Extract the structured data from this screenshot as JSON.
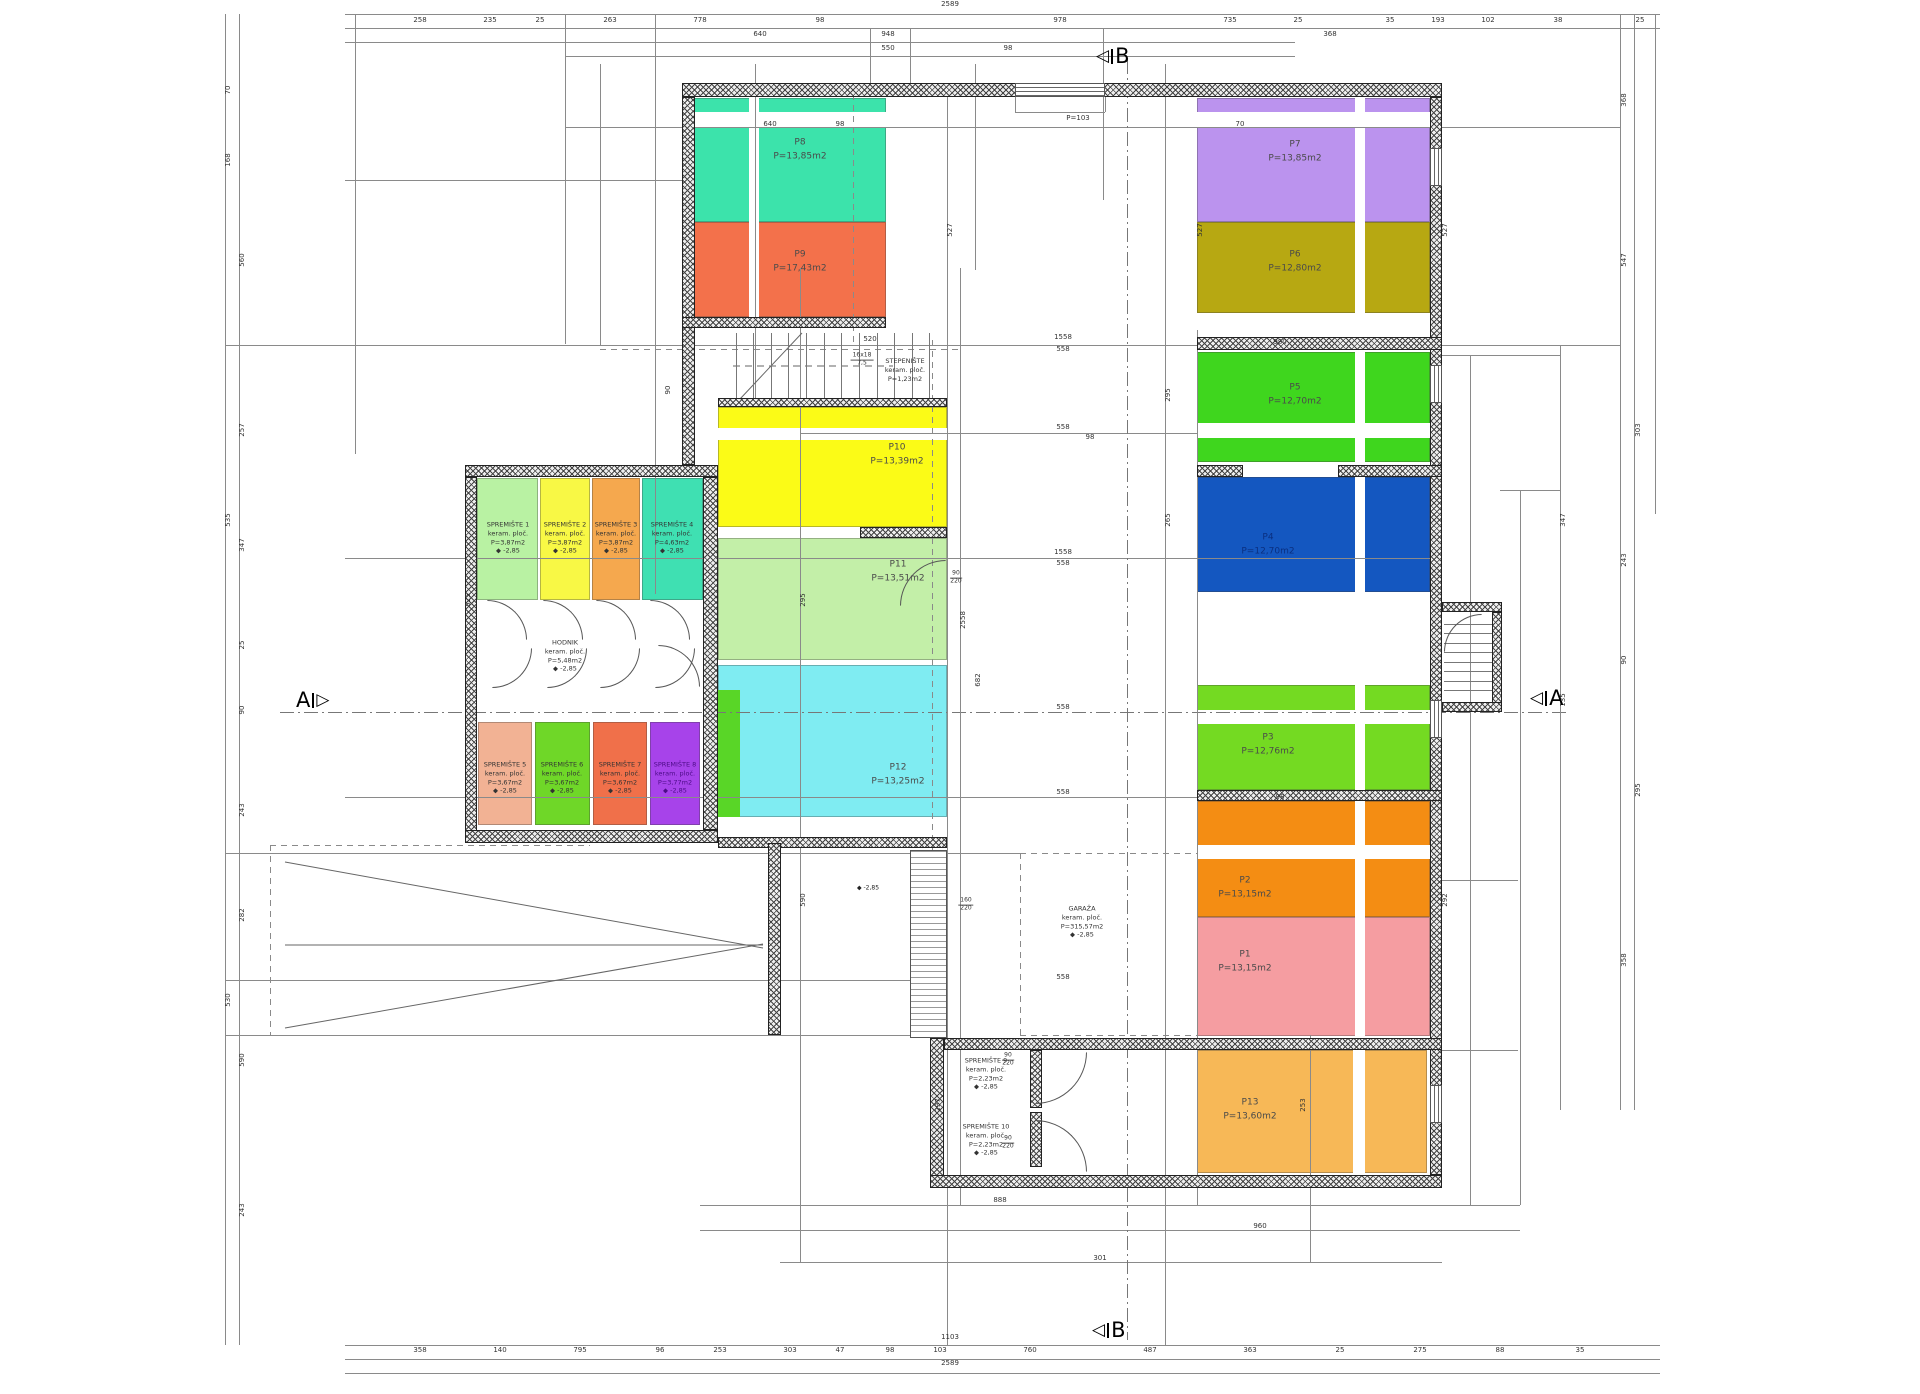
{
  "drawing": {
    "section_b": "B",
    "section_a": "A",
    "window_label": "P=103",
    "ramp_level": "-2,85",
    "level_symbol": "◆"
  },
  "rooms": [
    {
      "id": "p8",
      "name": "P8",
      "area": "P=13,85m2",
      "color": "#3ce3ab",
      "x": 694,
      "y": 98,
      "w": 192,
      "h": 124,
      "lx": 800,
      "ly": 150
    },
    {
      "id": "p9",
      "name": "P9",
      "area": "P=17,43m2",
      "color": "#f3714b",
      "x": 694,
      "y": 222,
      "w": 192,
      "h": 95,
      "lx": 800,
      "ly": 262
    },
    {
      "id": "p7",
      "name": "P7",
      "area": "P=13,85m2",
      "color": "#bb93ee",
      "x": 1197,
      "y": 98,
      "w": 233,
      "h": 124,
      "lx": 1295,
      "ly": 152
    },
    {
      "id": "p6",
      "name": "P6",
      "area": "P=12,80m2",
      "color": "#b7a812",
      "x": 1197,
      "y": 222,
      "w": 233,
      "h": 91,
      "lx": 1295,
      "ly": 262
    },
    {
      "id": "p5",
      "name": "P5",
      "area": "P=12,70m2",
      "color": "#3fd61e",
      "x": 1197,
      "y": 352,
      "w": 233,
      "h": 110,
      "lx": 1295,
      "ly": 395
    },
    {
      "id": "p4",
      "name": "P4",
      "area": "P=12,70m2",
      "color": "#1457c0",
      "x": 1197,
      "y": 477,
      "w": 233,
      "h": 115,
      "lx": 1268,
      "ly": 545,
      "tc": "#0a2f80"
    },
    {
      "id": "p3",
      "name": "P3",
      "area": "P=12,76m2",
      "color": "#74da22",
      "x": 1197,
      "y": 685,
      "w": 233,
      "h": 105,
      "lx": 1268,
      "ly": 745
    },
    {
      "id": "p2",
      "name": "P2",
      "area": "P=13,15m2",
      "color": "#f48d13",
      "x": 1197,
      "y": 801,
      "w": 233,
      "h": 116,
      "lx": 1245,
      "ly": 888
    },
    {
      "id": "p1",
      "name": "P1",
      "area": "P=13,15m2",
      "color": "#f59da1",
      "x": 1197,
      "y": 917,
      "w": 233,
      "h": 119,
      "lx": 1245,
      "ly": 962
    },
    {
      "id": "p13",
      "name": "P13",
      "area": "P=13,60m2",
      "color": "#f7b857",
      "x": 1197,
      "y": 1050,
      "w": 230,
      "h": 123,
      "lx": 1250,
      "ly": 1110
    },
    {
      "id": "p10",
      "name": "P10",
      "area": "P=13,39m2",
      "color": "#fbfb17",
      "x": 718,
      "y": 407,
      "w": 229,
      "h": 120,
      "lx": 897,
      "ly": 455
    },
    {
      "id": "p11",
      "name": "P11",
      "area": "P=13,51m2",
      "color": "#c3efa8",
      "x": 718,
      "y": 538,
      "w": 229,
      "h": 122,
      "lx": 898,
      "ly": 572
    },
    {
      "id": "p12",
      "name": "P12",
      "area": "P=13,25m2",
      "color": "#7fecf2",
      "x": 718,
      "y": 665,
      "w": 229,
      "h": 152,
      "lx": 898,
      "ly": 775
    }
  ],
  "fill_strips": [
    {
      "color": "#59d627",
      "x": 718,
      "y": 690,
      "w": 22,
      "h": 127
    }
  ],
  "white_strips": [
    [
      749,
      98,
      10,
      219
    ],
    [
      1355,
      98,
      10,
      215
    ],
    [
      1355,
      352,
      10,
      240
    ],
    [
      1355,
      685,
      10,
      351
    ],
    [
      1353,
      1050,
      12,
      123
    ],
    [
      694,
      112,
      192,
      15
    ],
    [
      1197,
      112,
      233,
      15
    ],
    [
      1197,
      423,
      233,
      15
    ],
    [
      1197,
      710,
      233,
      14
    ],
    [
      1197,
      845,
      233,
      14
    ],
    [
      718,
      428,
      229,
      12
    ]
  ],
  "storages": [
    {
      "id": "s1",
      "name": "SPREMIŠTE 1",
      "mat": "keram. ploč.",
      "area": "P=3,87m2",
      "level": "-2,85",
      "color": "#b9f2a3",
      "x": 477,
      "y": 478,
      "w": 61,
      "h": 122,
      "lx": 508,
      "ly": 538
    },
    {
      "id": "s2",
      "name": "SPREMIŠTE 2",
      "mat": "keram. ploč.",
      "area": "P=3,87m2",
      "level": "-2,85",
      "color": "#f8f845",
      "x": 540,
      "y": 478,
      "w": 50,
      "h": 122,
      "lx": 565,
      "ly": 538
    },
    {
      "id": "s3",
      "name": "SPREMIŠTE 3",
      "mat": "keram. ploč.",
      "area": "P=3,87m2",
      "level": "-2,85",
      "color": "#f5a84e",
      "x": 592,
      "y": 478,
      "w": 48,
      "h": 122,
      "lx": 616,
      "ly": 538
    },
    {
      "id": "s4",
      "name": "SPREMIŠTE 4",
      "mat": "keram. ploč.",
      "area": "P=4,63m2",
      "level": "-2,85",
      "color": "#3fe0b2",
      "x": 642,
      "y": 478,
      "w": 61,
      "h": 122,
      "lx": 672,
      "ly": 538
    },
    {
      "id": "s5",
      "name": "SPREMIŠTE 5",
      "mat": "keram. ploč.",
      "area": "P=3,67m2",
      "level": "-2,85",
      "color": "#f2b294",
      "x": 478,
      "y": 722,
      "w": 54,
      "h": 103,
      "lx": 505,
      "ly": 778
    },
    {
      "id": "s6",
      "name": "SPREMIŠTE 6",
      "mat": "keram. ploč.",
      "area": "P=3,67m2",
      "level": "-2,85",
      "color": "#6fd728",
      "x": 535,
      "y": 722,
      "w": 55,
      "h": 103,
      "lx": 562,
      "ly": 778
    },
    {
      "id": "s7",
      "name": "SPREMIŠTE 7",
      "mat": "keram. ploč.",
      "area": "P=3,67m2",
      "level": "-2,85",
      "color": "#f0704a",
      "x": 593,
      "y": 722,
      "w": 54,
      "h": 103,
      "lx": 620,
      "ly": 778
    },
    {
      "id": "s8",
      "name": "SPREMIŠTE 8",
      "mat": "keram. ploč.",
      "area": "P=3,77m2",
      "level": "-2,85",
      "color": "#a743ea",
      "x": 650,
      "y": 722,
      "w": 50,
      "h": 103,
      "lx": 675,
      "ly": 778,
      "tc": "#4b0b86"
    },
    {
      "id": "s9",
      "name": "SPREMIŠTE 9",
      "mat": "keram. ploč.",
      "area": "P=2,23m2",
      "level": "-2,85",
      "color": "transparent",
      "x": 944,
      "y": 1050,
      "w": 86,
      "h": 62,
      "lx": 986,
      "ly": 1074
    },
    {
      "id": "s10",
      "name": "SPREMIŠTE 10",
      "mat": "keram. ploč.",
      "area": "P=2,23m2",
      "level": "-2,85",
      "color": "transparent",
      "x": 944,
      "y": 1112,
      "w": 86,
      "h": 62,
      "lx": 986,
      "ly": 1140
    }
  ],
  "areas": [
    {
      "id": "stepeniste",
      "name": "STEPENIŠTE",
      "mat": "keram. ploč.",
      "area": "P=1,23m2",
      "level": "",
      "lx": 905,
      "ly": 370
    },
    {
      "id": "hodnik",
      "name": "HODNIK",
      "mat": "keram. ploč.",
      "area": "P=5,48m2",
      "level": "-2,85",
      "lx": 565,
      "ly": 656
    },
    {
      "id": "garaza",
      "name": "GARAŽA",
      "mat": "keram. ploč.",
      "area": "P=315,57m2",
      "level": "-2,85",
      "lx": 1082,
      "ly": 922
    }
  ],
  "walls": [
    [
      682,
      83,
      760,
      14
    ],
    [
      682,
      97,
      13,
      368
    ],
    [
      1430,
      97,
      12,
      1078
    ],
    [
      465,
      465,
      253,
      12
    ],
    [
      465,
      477,
      12,
      366
    ],
    [
      465,
      830,
      253,
      13
    ],
    [
      703,
      477,
      15,
      353
    ],
    [
      1197,
      337,
      245,
      13
    ],
    [
      1197,
      465,
      46,
      12
    ],
    [
      1338,
      465,
      104,
      12
    ],
    [
      1197,
      790,
      245,
      11
    ],
    [
      682,
      317,
      204,
      11
    ],
    [
      718,
      398,
      229,
      9
    ],
    [
      860,
      527,
      87,
      11
    ],
    [
      718,
      837,
      229,
      11
    ],
    [
      768,
      843,
      13,
      192
    ],
    [
      930,
      1038,
      14,
      150
    ],
    [
      944,
      1038,
      498,
      12
    ],
    [
      930,
      1175,
      512,
      13
    ],
    [
      1030,
      1050,
      12,
      58
    ],
    [
      1030,
      1112,
      12,
      55
    ],
    [
      1442,
      602,
      60,
      10
    ],
    [
      1492,
      612,
      10,
      100
    ],
    [
      1442,
      702,
      60,
      10
    ]
  ],
  "windows": [
    [
      1015,
      83,
      90,
      14,
      "h"
    ],
    [
      1430,
      148,
      12,
      38,
      "v"
    ],
    [
      1430,
      365,
      12,
      38,
      "v"
    ],
    [
      1430,
      700,
      12,
      38,
      "v"
    ],
    [
      1430,
      1085,
      12,
      38,
      "v"
    ]
  ],
  "doors": [
    {
      "x": 487,
      "y": 600,
      "r": 40,
      "c": "tr"
    },
    {
      "x": 543,
      "y": 600,
      "r": 40,
      "c": "tr"
    },
    {
      "x": 596,
      "y": 600,
      "r": 40,
      "c": "tr"
    },
    {
      "x": 650,
      "y": 600,
      "r": 40,
      "c": "tr"
    },
    {
      "x": 492,
      "y": 648,
      "r": 40,
      "c": "br"
    },
    {
      "x": 547,
      "y": 648,
      "r": 40,
      "c": "br"
    },
    {
      "x": 600,
      "y": 648,
      "r": 40,
      "c": "br"
    },
    {
      "x": 655,
      "y": 648,
      "r": 40,
      "c": "br"
    },
    {
      "x": 658,
      "y": 645,
      "r": 42,
      "c": "tr"
    },
    {
      "x": 900,
      "y": 560,
      "r": 46,
      "c": "tl"
    },
    {
      "x": 1035,
      "y": 1052,
      "r": 52,
      "c": "br"
    },
    {
      "x": 1035,
      "y": 1120,
      "r": 52,
      "c": "tr"
    },
    {
      "x": 1444,
      "y": 614,
      "r": 38,
      "c": "tl"
    }
  ],
  "treads": [
    {
      "x": 718,
      "y": 333,
      "w": 229,
      "h": 66,
      "n": 13,
      "o": "v"
    },
    {
      "x": 1444,
      "y": 614,
      "w": 48,
      "h": 86,
      "n": 9,
      "o": "h"
    }
  ],
  "grate": {
    "x": 910,
    "y": 850,
    "w": 37,
    "h": 188
  },
  "dim_lines": [
    [
      "h",
      345,
      14,
      1315
    ],
    [
      "h",
      345,
      28,
      1315
    ],
    [
      "h",
      345,
      42,
      950
    ],
    [
      "h",
      565,
      56,
      730
    ],
    [
      "h",
      345,
      1345,
      1315
    ],
    [
      "h",
      345,
      1359,
      1315
    ],
    [
      "h",
      345,
      1373,
      1315
    ],
    [
      "h",
      345,
      180,
      349
    ],
    [
      "h",
      565,
      127,
      1055
    ],
    [
      "h",
      225,
      345,
      1395
    ],
    [
      "h",
      800,
      433,
      397
    ],
    [
      "h",
      345,
      558,
      1097
    ],
    [
      "h",
      280,
      712,
      1290,
      "dd"
    ],
    [
      "h",
      345,
      797,
      852
    ],
    [
      "h",
      225,
      853,
      795
    ],
    [
      "h",
      225,
      980,
      705
    ],
    [
      "h",
      225,
      1035,
      705
    ],
    [
      "h",
      700,
      1205,
      820
    ],
    [
      "h",
      700,
      1230,
      820
    ],
    [
      "h",
      780,
      1262,
      662
    ],
    [
      "h",
      1442,
      355,
      118
    ],
    [
      "h",
      1500,
      490,
      60
    ],
    [
      "h",
      1442,
      880,
      76
    ],
    [
      "h",
      1442,
      1050,
      76
    ],
    [
      "h",
      270,
      845,
      320,
      "da"
    ],
    [
      "h",
      270,
      1035,
      430,
      "da"
    ],
    [
      "h",
      1020,
      853,
      177,
      "da"
    ],
    [
      "h",
      1020,
      1035,
      177,
      "da"
    ],
    [
      "h",
      600,
      349,
      360,
      "da"
    ],
    [
      "h",
      1015,
      112,
      90
    ],
    [
      "v",
      1015,
      97,
      15
    ],
    [
      "v",
      1105,
      97,
      15
    ],
    [
      "v",
      225,
      14,
      1331
    ],
    [
      "v",
      239,
      14,
      1331
    ],
    [
      "v",
      355,
      14,
      440
    ],
    [
      "v",
      565,
      14,
      330
    ],
    [
      "v",
      600,
      64,
      281
    ],
    [
      "v",
      655,
      14,
      580
    ],
    [
      "v",
      694,
      270,
      75
    ],
    [
      "v",
      755,
      64,
      343
    ],
    [
      "v",
      800,
      268,
      994
    ],
    [
      "v",
      870,
      28,
      55
    ],
    [
      "v",
      910,
      28,
      55
    ],
    [
      "v",
      947,
      83,
      1262
    ],
    [
      "v",
      960,
      268,
      937
    ],
    [
      "v",
      975,
      64,
      206
    ],
    [
      "v",
      1103,
      28,
      172
    ],
    [
      "v",
      1165,
      64,
      1281
    ],
    [
      "v",
      1197,
      330,
      875
    ],
    [
      "v",
      1310,
      1035,
      227
    ],
    [
      "v",
      1470,
      355,
      850
    ],
    [
      "v",
      1520,
      490,
      715
    ],
    [
      "v",
      1560,
      345,
      765
    ],
    [
      "v",
      1620,
      14,
      1096
    ],
    [
      "v",
      1634,
      14,
      1096
    ],
    [
      "v",
      1655,
      14,
      500
    ],
    [
      "v",
      1127,
      60,
      1280,
      "dd"
    ],
    [
      "v",
      932,
      340,
      700,
      "da"
    ],
    [
      "v",
      853,
      83,
      262,
      "da"
    ],
    [
      "v",
      270,
      845,
      190,
      "da"
    ],
    [
      "v",
      1020,
      853,
      182,
      "da"
    ]
  ],
  "dim_labels": [
    [
      950,
      4,
      "2589"
    ],
    [
      420,
      20,
      "258"
    ],
    [
      490,
      20,
      "235"
    ],
    [
      540,
      20,
      "25"
    ],
    [
      610,
      20,
      "263"
    ],
    [
      700,
      20,
      "778"
    ],
    [
      760,
      34,
      "640"
    ],
    [
      820,
      20,
      "98"
    ],
    [
      888,
      34,
      "948"
    ],
    [
      888,
      48,
      "550"
    ],
    [
      1008,
      48,
      "98"
    ],
    [
      1060,
      20,
      "978"
    ],
    [
      1230,
      20,
      "735"
    ],
    [
      1298,
      20,
      "25"
    ],
    [
      1330,
      34,
      "368"
    ],
    [
      1390,
      20,
      "35"
    ],
    [
      1438,
      20,
      "193"
    ],
    [
      1488,
      20,
      "102"
    ],
    [
      1558,
      20,
      "38"
    ],
    [
      1640,
      20,
      "25"
    ],
    [
      950,
      1337,
      "1103"
    ],
    [
      950,
      1363,
      "2589"
    ],
    [
      420,
      1350,
      "358"
    ],
    [
      500,
      1350,
      "140"
    ],
    [
      580,
      1350,
      "795"
    ],
    [
      660,
      1350,
      "96"
    ],
    [
      720,
      1350,
      "253"
    ],
    [
      790,
      1350,
      "303"
    ],
    [
      840,
      1350,
      "47"
    ],
    [
      890,
      1350,
      "98"
    ],
    [
      940,
      1350,
      "103"
    ],
    [
      1030,
      1350,
      "760"
    ],
    [
      1150,
      1350,
      "487"
    ],
    [
      1250,
      1350,
      "363"
    ],
    [
      1340,
      1350,
      "25"
    ],
    [
      1420,
      1350,
      "275"
    ],
    [
      1500,
      1350,
      "88"
    ],
    [
      1580,
      1350,
      "35"
    ],
    [
      228,
      90,
      "70",
      1
    ],
    [
      228,
      160,
      "168",
      1
    ],
    [
      242,
      260,
      "560",
      1
    ],
    [
      242,
      430,
      "257",
      1
    ],
    [
      242,
      545,
      "347",
      1
    ],
    [
      242,
      645,
      "25",
      1
    ],
    [
      242,
      710,
      "90",
      1
    ],
    [
      242,
      810,
      "243",
      1
    ],
    [
      242,
      915,
      "282",
      1
    ],
    [
      242,
      1060,
      "590",
      1
    ],
    [
      242,
      1210,
      "243",
      1
    ],
    [
      228,
      520,
      "535",
      1
    ],
    [
      228,
      1000,
      "530",
      1
    ],
    [
      1624,
      100,
      "368",
      1
    ],
    [
      1624,
      260,
      "547",
      1
    ],
    [
      1638,
      430,
      "303",
      1
    ],
    [
      1624,
      560,
      "243",
      1
    ],
    [
      1624,
      660,
      "90",
      1
    ],
    [
      1638,
      790,
      "295",
      1
    ],
    [
      1624,
      960,
      "358",
      1
    ],
    [
      1563,
      520,
      "347",
      1
    ],
    [
      1563,
      700,
      "135",
      1
    ],
    [
      1063,
      337,
      "1558"
    ],
    [
      1063,
      349,
      "558"
    ],
    [
      870,
      339,
      "520"
    ],
    [
      1063,
      427,
      "558"
    ],
    [
      1090,
      437,
      "98"
    ],
    [
      1063,
      552,
      "1558"
    ],
    [
      1063,
      563,
      "558"
    ],
    [
      1280,
      342,
      "980"
    ],
    [
      1240,
      124,
      "70"
    ],
    [
      770,
      124,
      "640"
    ],
    [
      840,
      124,
      "98"
    ],
    [
      1063,
      707,
      "558"
    ],
    [
      1063,
      792,
      "558"
    ],
    [
      1280,
      797,
      "98"
    ],
    [
      1063,
      977,
      "558"
    ],
    [
      1000,
      1200,
      "888"
    ],
    [
      1260,
      1226,
      "960"
    ],
    [
      1100,
      1258,
      "301"
    ],
    [
      1078,
      118,
      "P=103"
    ],
    [
      950,
      230,
      "527",
      1
    ],
    [
      1200,
      230,
      "527",
      1
    ],
    [
      1445,
      230,
      "527",
      1
    ],
    [
      1168,
      395,
      "295",
      1
    ],
    [
      1168,
      520,
      "265",
      1
    ],
    [
      963,
      620,
      "2558",
      1
    ],
    [
      978,
      680,
      "682",
      1
    ],
    [
      1445,
      900,
      "292",
      1
    ],
    [
      938,
      1105,
      "297",
      1
    ],
    [
      1303,
      1105,
      "253",
      1
    ],
    [
      803,
      600,
      "295",
      1
    ],
    [
      803,
      900,
      "590",
      1
    ],
    [
      668,
      390,
      "90",
      1
    ],
    [
      468,
      600,
      "525",
      1
    ]
  ],
  "fracs": [
    [
      1008,
      1060,
      "90",
      "220"
    ],
    [
      1008,
      1143,
      "90",
      "220"
    ],
    [
      956,
      578,
      "90",
      "220"
    ],
    [
      966,
      905,
      "160",
      "220"
    ],
    [
      862,
      360,
      "16x18",
      "7,5"
    ]
  ],
  "levels": [
    [
      868,
      888
    ]
  ],
  "markers": [
    {
      "letter": "B",
      "x": 1096,
      "y": 44,
      "dir": "left"
    },
    {
      "letter": "B",
      "x": 1092,
      "y": 1318,
      "dir": "left"
    },
    {
      "letter": "A",
      "x": 296,
      "y": 688,
      "dir": "right"
    },
    {
      "letter": "A",
      "x": 1530,
      "y": 686,
      "dir": "left"
    }
  ],
  "svg_lines": [
    [
      285,
      862,
      763,
      948,
      0
    ],
    [
      285,
      1028,
      763,
      944,
      0
    ],
    [
      285,
      945,
      763,
      945,
      0
    ],
    [
      740,
      399,
      802,
      333,
      0
    ],
    [
      733,
      366,
      893,
      366,
      1
    ]
  ]
}
